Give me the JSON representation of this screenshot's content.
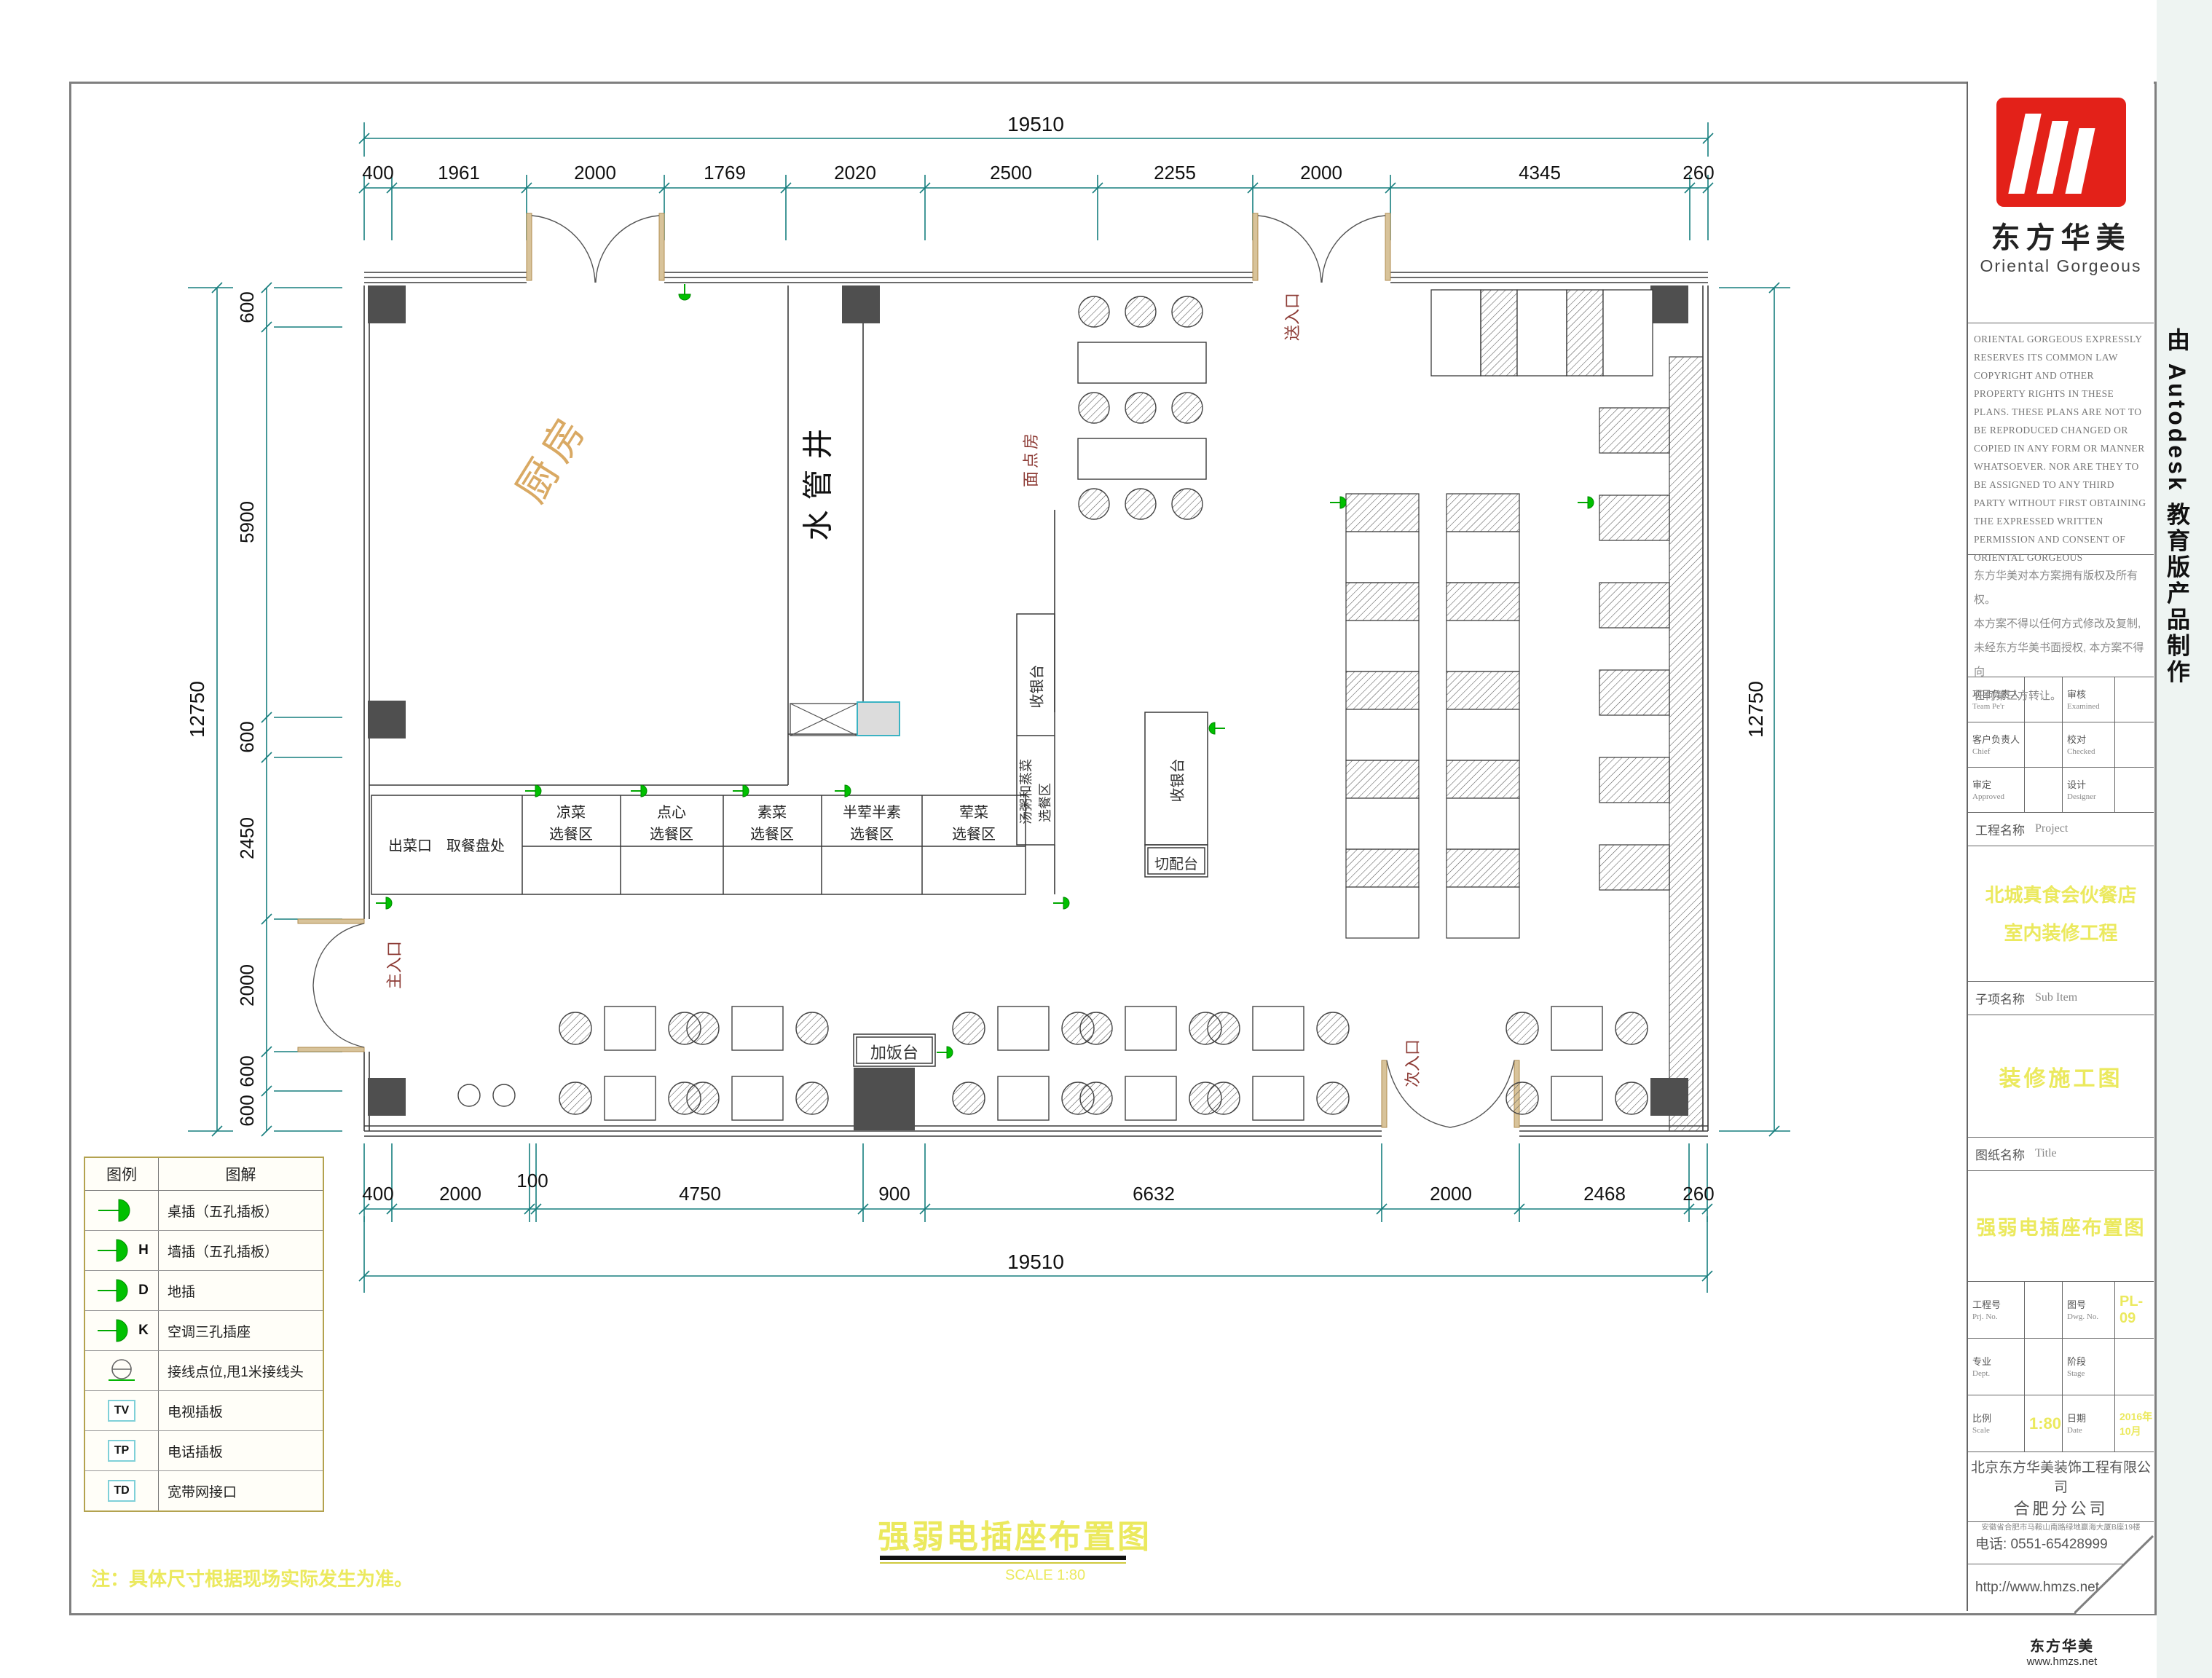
{
  "page": {
    "main_title": "强弱电插座布置图",
    "scale_note": "SCALE  1:80",
    "note": "注：具体尺寸根据现场实际发生为准。",
    "side_banner": "由 Autodesk 教育版产品制作",
    "watermark_name": "东方华美",
    "watermark_site": "www.hmzs.net"
  },
  "dims": {
    "top_total": "19510",
    "top": [
      "400",
      "1961",
      "2000",
      "1769",
      "2020",
      "2500",
      "2255",
      "2000",
      "4345",
      "260"
    ],
    "left_total": "12750",
    "left": [
      "600",
      "5900",
      "600",
      "2450",
      "2000",
      "600",
      "600"
    ],
    "right_total": "12750",
    "bottom": [
      "400",
      "2000",
      "100",
      "4750",
      "900",
      "6632",
      "2000",
      "2468",
      "260"
    ],
    "bottom_total": "19510"
  },
  "plan": {
    "kitchen": "厨房",
    "water_shaft": "水管井",
    "pastry_room": "面点房",
    "main_entrance": "主入口",
    "secondary_entrance": "次入口",
    "service_entrance": "送入口",
    "serving_out": "出菜口　取餐盘处",
    "counters": [
      {
        "l1": "凉菜",
        "l2": "选餐区"
      },
      {
        "l1": "点心",
        "l2": "选餐区"
      },
      {
        "l1": "素菜",
        "l2": "选餐区"
      },
      {
        "l1": "半荤半素",
        "l2": "选餐区"
      },
      {
        "l1": "荤菜",
        "l2": "选餐区"
      }
    ],
    "soup_line1": "汤粥和蒸菜",
    "soup_line2": "选餐区",
    "cashier": "收银台",
    "prep_counter": "切配台",
    "rice_counter": "加饭台"
  },
  "legend": {
    "title_symbol": "图例",
    "title_desc": "图解",
    "rows": [
      {
        "suffix": "",
        "code": "",
        "label": "桌插（五孔插板）"
      },
      {
        "suffix": "H",
        "code": "",
        "label": "墙插（五孔插板）"
      },
      {
        "suffix": "D",
        "code": "",
        "label": "地插"
      },
      {
        "suffix": "K",
        "code": "",
        "label": "空调三孔插座"
      },
      {
        "suffix": "",
        "code": "",
        "label": "接线点位,甩1米接线头"
      },
      {
        "suffix": "",
        "code": "TV",
        "label": "电视插板"
      },
      {
        "suffix": "",
        "code": "TP",
        "label": "电话插板"
      },
      {
        "suffix": "",
        "code": "TD",
        "label": "宽带网接口"
      }
    ]
  },
  "titleblock": {
    "logo_cn": "东方华美",
    "logo_en": "Oriental Gorgeous",
    "copyright_en": "ORIENTAL GORGEOUS EXPRESSLY RESERVES ITS COMMON LAW COPYRIGHT AND OTHER PROPERTY RIGHTS IN THESE PLANS. THESE PLANS ARE NOT TO BE REPRODUCED CHANGED OR COPIED IN ANY FORM OR MANNER WHATSOEVER. NOR ARE THEY TO BE ASSIGNED TO ANY THIRD PARTY WITHOUT FIRST OBTAINING THE EXPRESSED WRITTEN PERMISSION AND CONSENT OF ORIENTAL GORGEOUS",
    "copyright_cn": [
      "东方华美对本方案拥有版权及所有权。",
      "本方案不得以任何方式修改及复制,",
      "未经东方华美书面授权, 本方案不得向",
      "任何第三方转让。"
    ],
    "staff": [
      {
        "cn": "项目负责人",
        "en": "Team Pe'r",
        "cn2": "审核",
        "en2": "Examined"
      },
      {
        "cn": "客户负责人",
        "en": "Chief",
        "cn2": "校对",
        "en2": "Checked"
      },
      {
        "cn": "审定",
        "en": "Approved",
        "cn2": "设计",
        "en2": "Designer"
      }
    ],
    "project_label_cn": "工程名称",
    "project_label_en": "Project",
    "project_name_1": "北城真食会伙餐店",
    "project_name_2": "室内装修工程",
    "subitem_label_cn": "子项名称",
    "subitem_label_en": "Sub Item",
    "subitem_name": "装修施工图",
    "title_label_cn": "图纸名称",
    "title_label_en": "Title",
    "drawing_title": "强弱电插座布置图",
    "meta": [
      {
        "cn": "工程号",
        "en": "Prj. No.",
        "val": "",
        "cn2": "图号",
        "en2": "Dwg. No.",
        "val2": "PL-09"
      },
      {
        "cn": "专业",
        "en": "Dept.",
        "val": "",
        "cn2": "阶段",
        "en2": "Stage",
        "val2": ""
      },
      {
        "cn": "比例",
        "en": "Scale",
        "val": "1:80",
        "cn2": "日期",
        "en2": "Date",
        "val2": "2016年10月"
      }
    ],
    "company": "北京东方华美装饰工程有限公司",
    "branch": "合肥分公司",
    "address": "安徽省合肥市马鞍山南路绿地赢海大厦B座19楼",
    "phone": "电话: 0551-65428999",
    "website": "http://www.hmzs.net"
  }
}
